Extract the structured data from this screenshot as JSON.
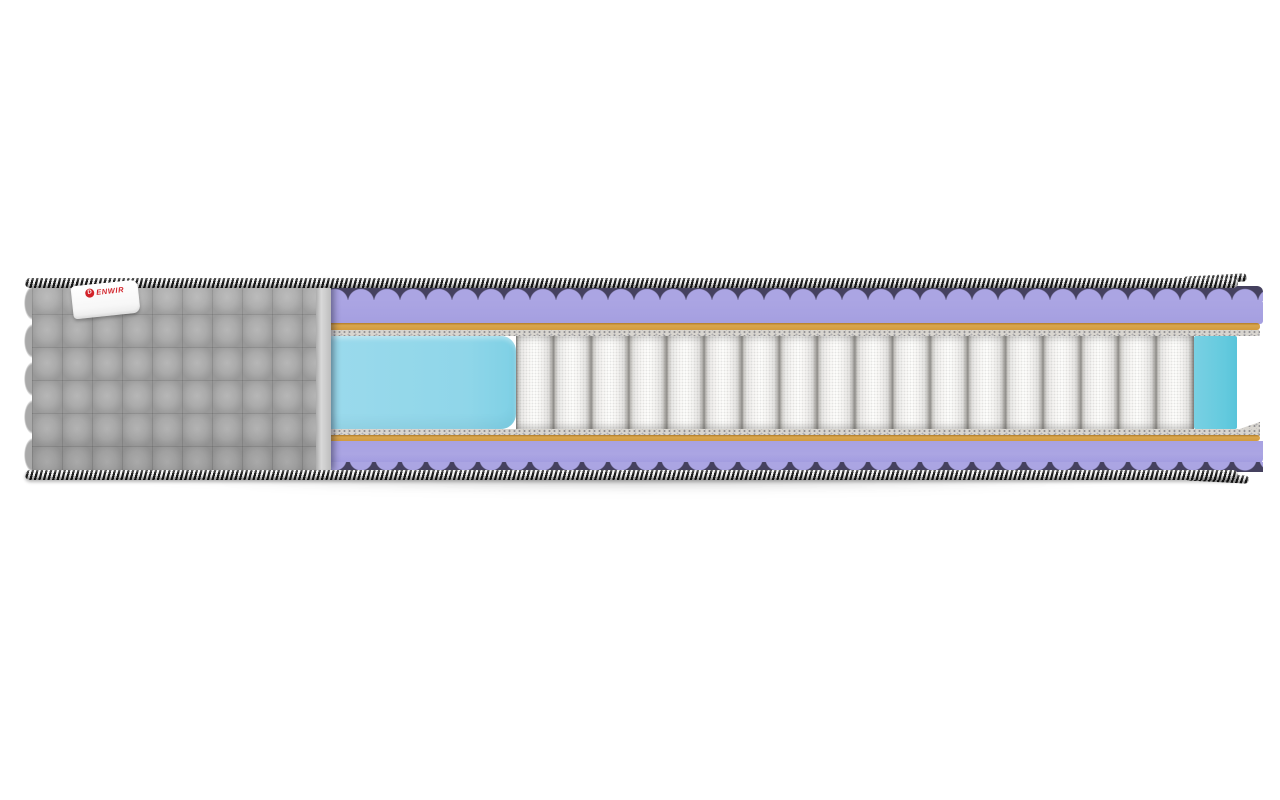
{
  "scene": {
    "description": "Cutaway product render of a pocket-spring mattress, side cross-section view",
    "brand_label": {
      "logo_letter": "D",
      "text": "ENWIR",
      "full_brand": "DENWIR"
    }
  },
  "layers": [
    {
      "name": "quilted-fabric-cover",
      "color": "#a9a9a9"
    },
    {
      "name": "braided-edge-piping",
      "colors": [
        "#1b1b1b",
        "#f5f5f5"
      ]
    },
    {
      "name": "wave-cut-foam-top",
      "color": "#aba5e3"
    },
    {
      "name": "coir-sheet-top",
      "color": "#d9a64e"
    },
    {
      "name": "felt-pad-top",
      "color": "#d8d5cf"
    },
    {
      "name": "side-support-foam-left",
      "color": "#8fd6e9"
    },
    {
      "name": "pocket-spring-block",
      "color": "#f5f4f2"
    },
    {
      "name": "side-support-foam-right",
      "color": "#64cade"
    },
    {
      "name": "felt-pad-bottom",
      "color": "#d8d5cf"
    },
    {
      "name": "coir-sheet-bottom",
      "color": "#d9a64e"
    },
    {
      "name": "wave-cut-foam-bottom",
      "color": "#aba5e3"
    }
  ],
  "springs": {
    "count": 18
  },
  "colors": {
    "background": "#ffffff",
    "cover_gray": "#a9a9a9",
    "piping_black": "#1b1b1b",
    "piping_white": "#f5f5f5",
    "foam_purple": "#aba5e3",
    "foam_purple_dark": "#45415f",
    "coir_tan": "#d9a64e",
    "coir_tan_dark": "#b27c28",
    "felt_gray": "#d8d5cf",
    "foam_cyan": "#8fd6e9",
    "foam_cyan_dark": "#64cade",
    "spring_white": "#f5f4f2",
    "spring_gap": "#8e8c88",
    "label_red": "#d2232a",
    "shadow": "rgba(0,0,0,0.14)"
  }
}
